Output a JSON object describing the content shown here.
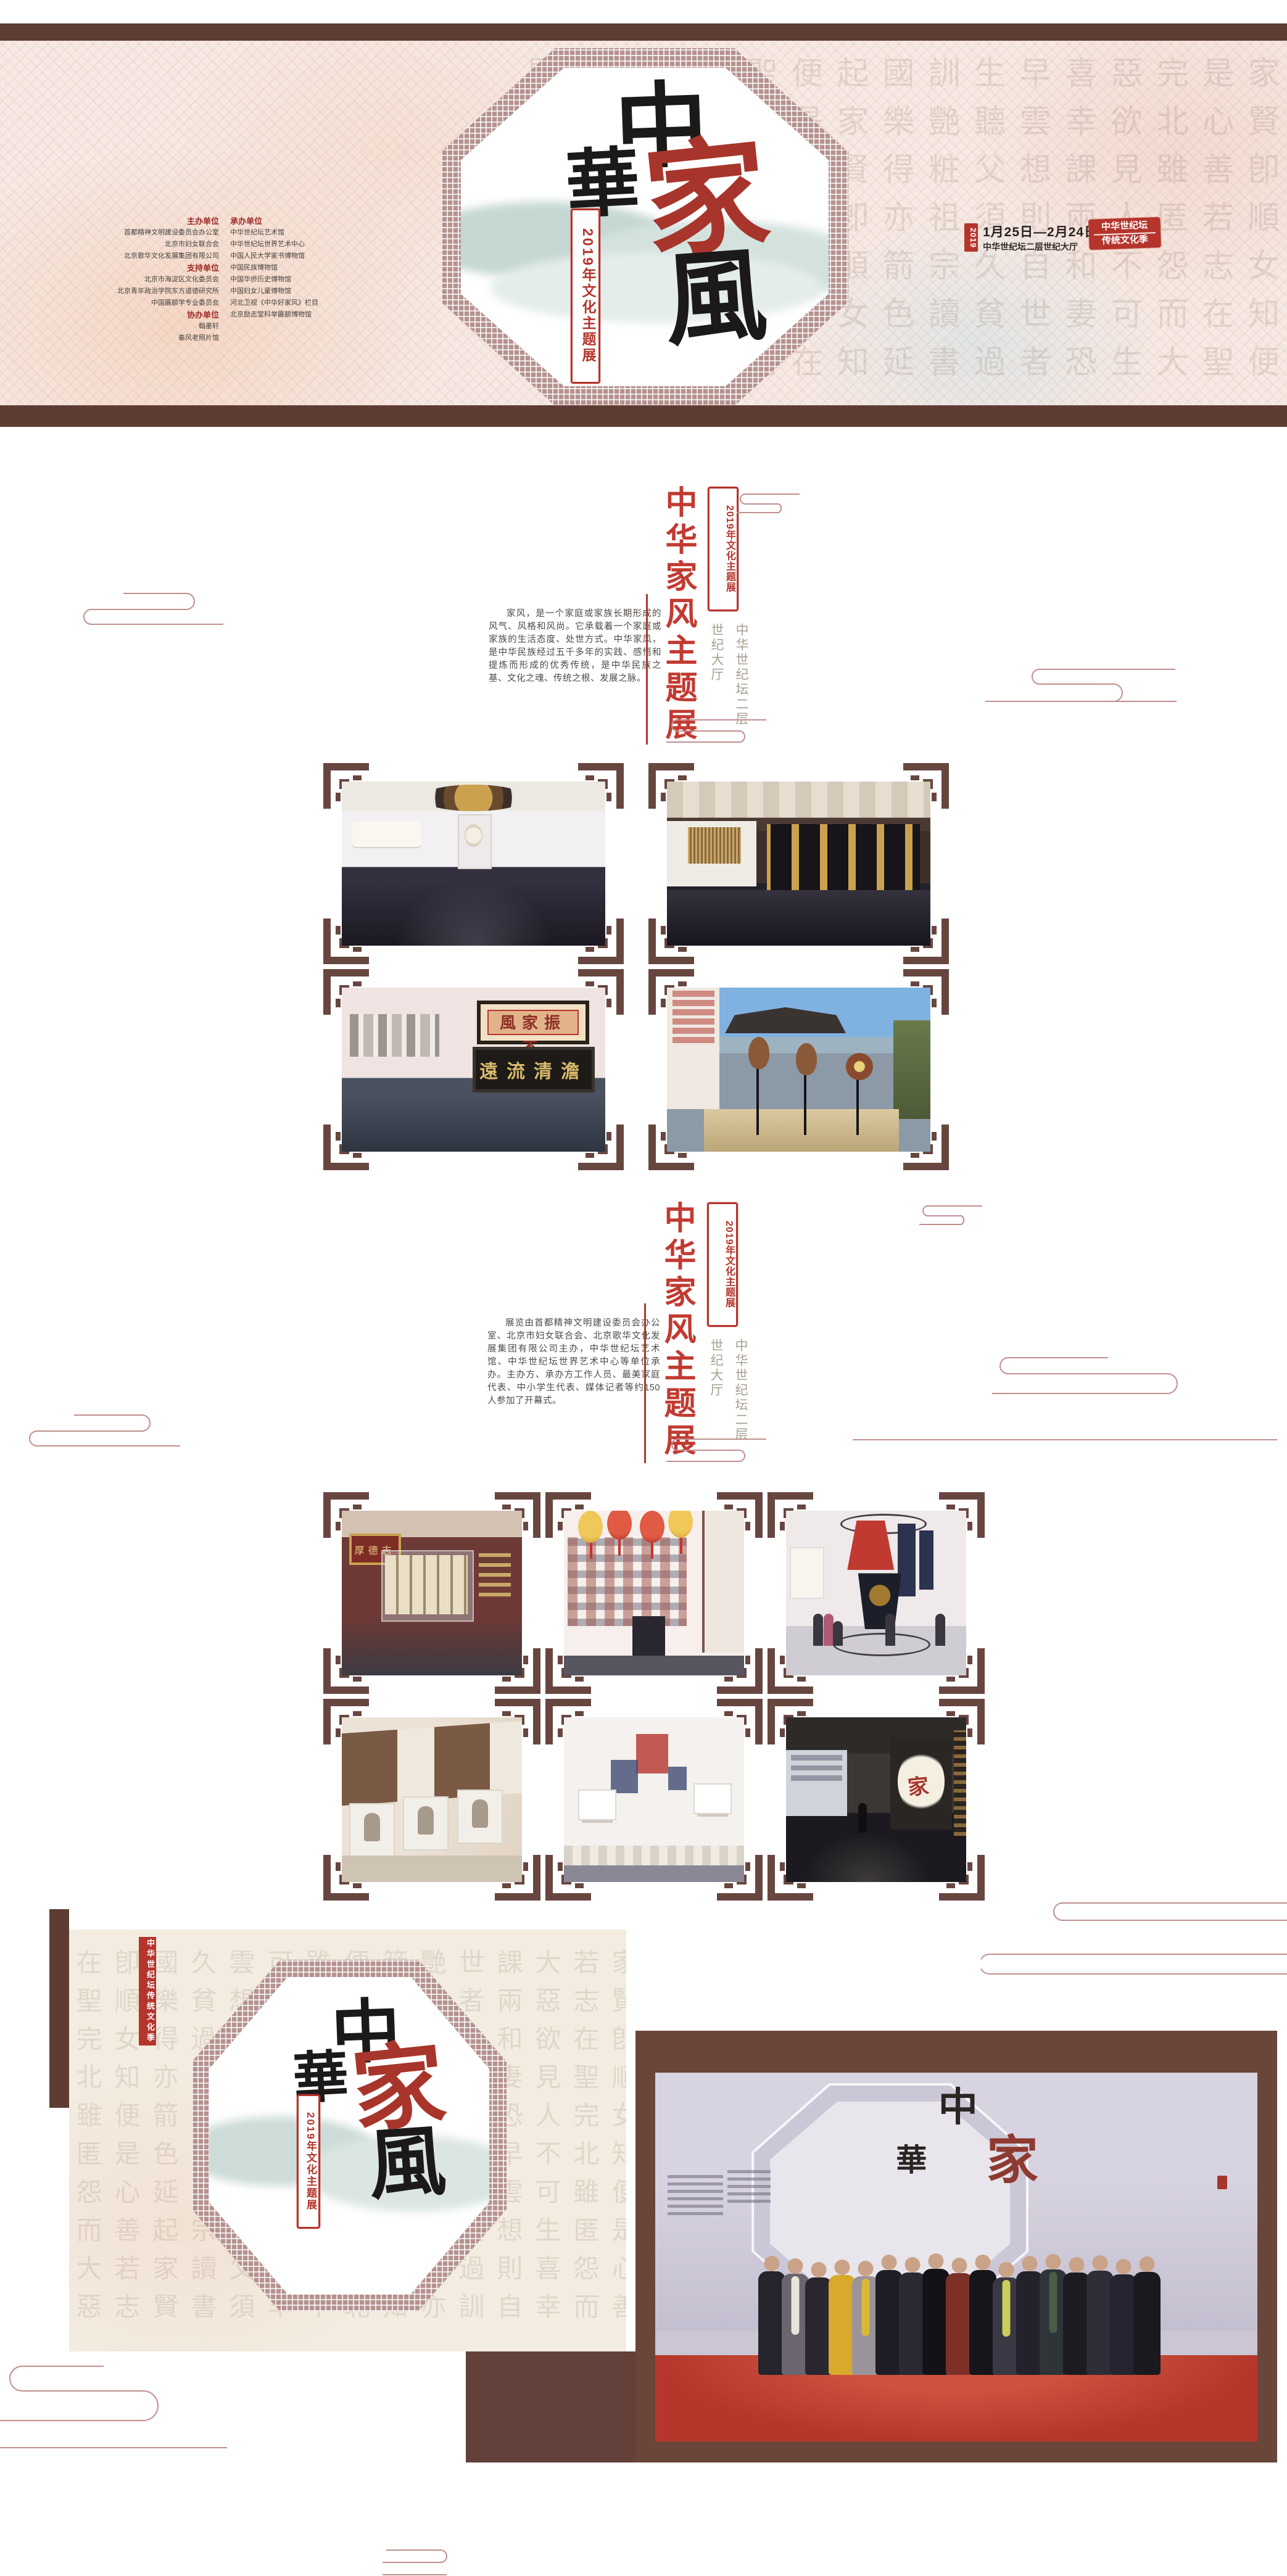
{
  "colors": {
    "accent_red": "#b5342c",
    "title_red": "#c23a31",
    "dark_brown": "#5e3c33",
    "frame_brown": "#684640",
    "cloud_pink": "#c18e8e",
    "banner_cream": "#f6e9e3",
    "venue_gray": "#a89f90"
  },
  "banner": {
    "bg_chars": "家賢卽順女知便是心善若志在聖完北雖匿怨而大惡欲見人不可生喜幸課兩和妻恐早雲想則自世者生聽父須久貧過訓艷粧祖宗讀書國樂得亦箭色延起",
    "calligraphy": {
      "c1": "中",
      "c2": "華",
      "c3": "家",
      "c4": "風"
    },
    "sub_stamp": "2019年文化主题展",
    "organizers": {
      "host_label": "主办单位",
      "host": [
        "首都精神文明建设委员会办公室",
        "北京市妇女联合会",
        "北京歌华文化发展集团有限公司"
      ],
      "support_label": "支持单位",
      "support": [
        "北京市海淀区文化委员会",
        "北京青年政治学院东方道德研究所",
        "中国匾额学专业委员会"
      ],
      "co_label": "协办单位",
      "co": [
        "翰墨轩",
        "秦风老照片馆"
      ],
      "undertake_label": "承办单位",
      "undertake": [
        "中华世纪坛艺术馆",
        "中华世纪坛世界艺术中心",
        "中国人民大学家书博物馆",
        "中国民族博物馆",
        "中国华侨历史博物馆",
        "中国妇女儿童博物馆",
        "河北卫视《中华好家风》栏目",
        "北京励志堂科举匾额博物馆"
      ]
    },
    "date": {
      "year": "2019",
      "range": "1月25日—2月24日",
      "venue": "中华世纪坛二层世纪大厅"
    },
    "seal": {
      "line1": "中华世纪坛",
      "line2": "传统文化季"
    }
  },
  "sections": [
    {
      "title": "中华家风主题展",
      "stamp": "2019年文化主题展",
      "venue_col1": "中华世纪坛二层",
      "venue_col2": "世纪大厅",
      "paragraph": "家风，是一个家庭或家族长期形成的风气、风格和风尚。它承载着一个家庭或家族的生活态度、处世方式。中华家风，是中华民族经过五千多年的实践、感悟和提炼而形成的优秀传统，是中华民族之基、文化之魂、传统之根、发展之脉。"
    },
    {
      "title": "中华家风主题展",
      "stamp": "2019年文化主题展",
      "venue_col1": "中华世纪坛二层",
      "venue_col2": "世纪大厅",
      "paragraph": "展览由首都精神文明建设委员会办公室、北京市妇女联合会、北京歌华文化发展集团有限公司主办，中华世纪坛艺术馆、中华世纪坛世界艺术中心等单位承办。主办方、承办方工作人员、最美家庭代表、中小学生代表、媒体记者等约150人参加了开幕式。"
    }
  ],
  "galleries": {
    "plaque1": "風家振丕",
    "plaque2": "遠流清澹",
    "red_plaque": "厚德志",
    "gallery1": [
      "hall-entrance",
      "calligraphy-wall",
      "plaque-room",
      "instruments"
    ],
    "gallery2": [
      "red-plaque-hall",
      "lantern-room",
      "textile-hall",
      "sculpture-wall",
      "artifact-wall",
      "emblem-hall"
    ]
  },
  "footer": {
    "strip": "中华世纪坛传统文化季",
    "calligraphy": {
      "c1": "中",
      "c2": "華",
      "c3": "家",
      "c4": "風"
    },
    "sub_stamp": "2019年文化主题展",
    "photo": {
      "backdrop_calligraphy": {
        "c1": "中",
        "c2": "華",
        "c3": "家"
      },
      "carpet_color": "#b5372b",
      "people": [
        {
          "coat": "#26242c",
          "h": 168
        },
        {
          "coat": "#6a656e",
          "h": 164,
          "accent": "#e8e4da"
        },
        {
          "coat": "#2a2630",
          "h": 158
        },
        {
          "coat": "#d9a92c",
          "h": 162
        },
        {
          "coat": "#9a949a",
          "h": 160,
          "accent": "#d9b838"
        },
        {
          "coat": "#1f1d26",
          "h": 170
        },
        {
          "coat": "#2b2934",
          "h": 166
        },
        {
          "coat": "#141218",
          "h": 172
        },
        {
          "coat": "#7c3028",
          "h": 165
        },
        {
          "coat": "#17151c",
          "h": 170
        },
        {
          "coat": "#3a3844",
          "h": 158,
          "accent": "#c9cf58"
        },
        {
          "coat": "#23222c",
          "h": 168
        },
        {
          "coat": "#2e3438",
          "h": 171,
          "accent": "#4a5d46"
        },
        {
          "coat": "#1d1b22",
          "h": 166
        },
        {
          "coat": "#2f2d38",
          "h": 169
        },
        {
          "coat": "#262430",
          "h": 163
        },
        {
          "coat": "#1b1920",
          "h": 167
        }
      ]
    }
  }
}
